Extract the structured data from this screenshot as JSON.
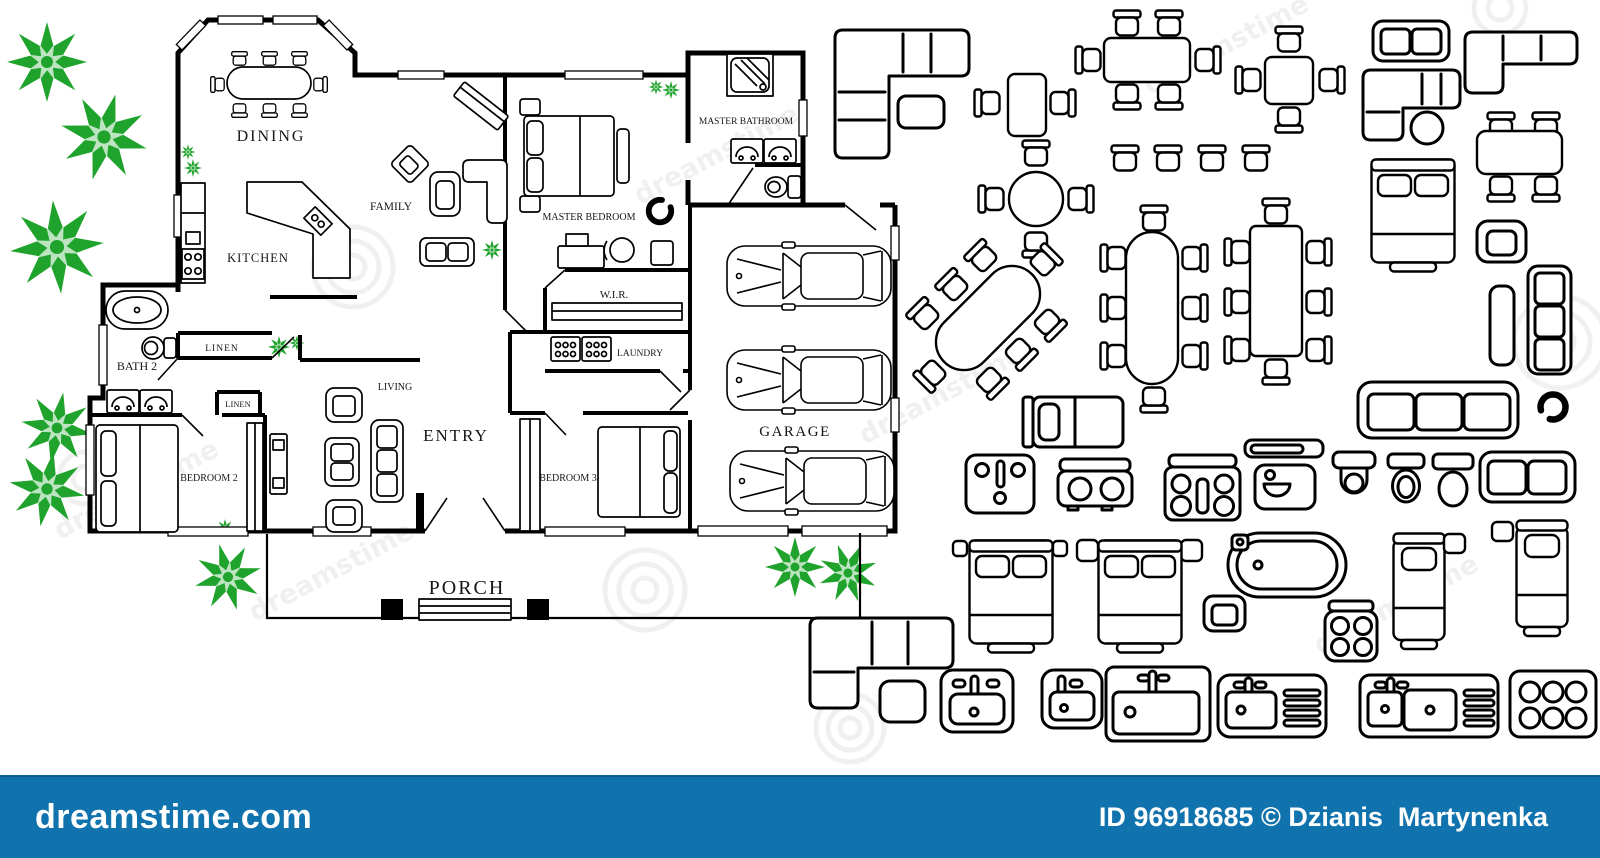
{
  "image": {
    "kind": "stock floor-plan illustration with furniture symbol set"
  },
  "watermark_bar": {
    "brand": "dreamstime.com",
    "credit": "ID 96918685 © Dzianis  Martynenka",
    "background": "#1173ad",
    "text_color": "#ffffff"
  },
  "watermark_ghost": {
    "text": "dreamstime",
    "color": "#777777"
  },
  "floorplan": {
    "wall_color": "#000000",
    "tree_color": "#1fa32c",
    "rooms": {
      "dining": "DINING",
      "kitchen": "KITCHEN",
      "family": "FAMILY",
      "master_bedroom": "MASTER BEDROOM",
      "master_bathroom": "MASTER BATHROOM",
      "wir": "W.I.R.",
      "laundry": "LAUNDRY",
      "garage": "GARAGE",
      "bath2": "BATH 2",
      "linen1": "LINEN",
      "linen2": "LINEN",
      "bedroom2": "BEDROOM 2",
      "bedroom3": "BEDROOM 3",
      "living": "LIVING",
      "entry": "ENTRY",
      "porch": "PORCH"
    },
    "elements": [
      "oval-dining-table-8-chairs",
      "corner-kitchen-counter",
      "stove",
      "fridge-counter",
      "family-sofa-set",
      "angled-cabinet",
      "master-bed",
      "desk-and-chair",
      "round-chair",
      "shower",
      "double-vanity",
      "toilet",
      "walk-in-robe-shelf",
      "washer-dryer",
      "three-cars",
      "bathtub",
      "beds",
      "wardrobes",
      "tv-unit",
      "living-sofa-set",
      "porch-steps",
      "porch-posts",
      "trees"
    ]
  },
  "furniture_library": [
    "corner-sofa",
    "ottoman",
    "table-2-chairs",
    "table-6-chairs",
    "chairs-row-4",
    "round-table-4-chairs",
    "square-table-4-chairs",
    "loveseat",
    "corner-sofa-2",
    "corner-sofa-pouf",
    "double-bed",
    "table-4-chairs",
    "armchair",
    "bench",
    "sofa-3-vertical",
    "swivel-chair",
    "oval-table-8-chairs-diagonal",
    "oval-table-8-chairs",
    "long-table-8-chairs",
    "single-bed-horizontal",
    "washbasin-cabinet",
    "cooktop-2-burner",
    "stove-4-burner-oven",
    "wall-shelf",
    "sink-unit",
    "toilet-round",
    "toilet-oval",
    "toilet-elongated",
    "loveseat-2",
    "sofa-3-horizontal",
    "bathtub-oval",
    "armchair-2",
    "cooktop-4-burner",
    "single-bed-vertical",
    "single-bed-vertical-2",
    "double-bed-nightstands",
    "double-bed-nightstands-2",
    "sectional-sofa-chaise",
    "washbasin-square",
    "washbasin-square-2",
    "sink-counter",
    "sink-drainboard",
    "sink-double-drainboard",
    "stove-6-burner"
  ]
}
